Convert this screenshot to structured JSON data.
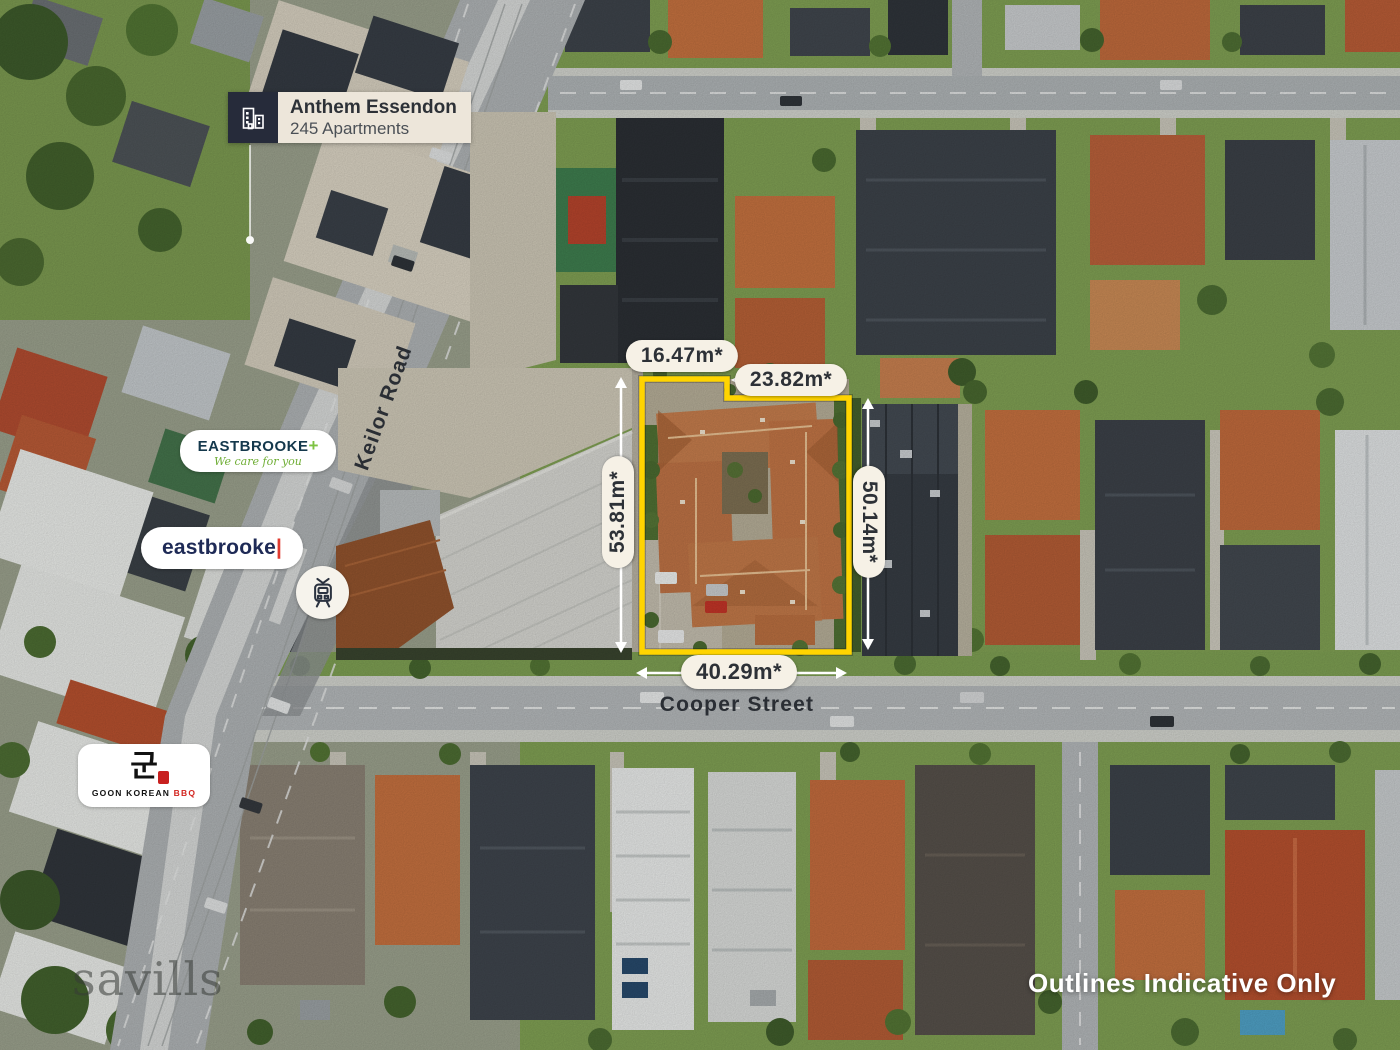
{
  "annotations": {
    "anthem": {
      "title": "Anthem Essendon",
      "subtitle": "245 Apartments"
    },
    "eastbrooke_medical": {
      "name": "EASTBROOKE",
      "plus": "+",
      "tagline": "We care for you"
    },
    "eastbrooke": {
      "name": "eastbrooke",
      "cursor": "|"
    },
    "goon": {
      "hangul": "군",
      "name_black": "GOON KOREAN",
      "name_red": "BBQ"
    },
    "streets": {
      "keilor": "Keilor Road",
      "cooper": "Cooper Street"
    },
    "dimensions": {
      "top_left": "16.47m*",
      "top_right": "23.82m*",
      "left": "53.81m*",
      "right": "50.14m*",
      "bottom": "40.29m*"
    },
    "watermark": "savills",
    "disclaimer": "Outlines Indicative Only"
  },
  "icons": {
    "tram": "tram-icon",
    "apartments": "building-icon"
  },
  "colors": {
    "boundary_yellow": "#FFD400",
    "pill_bg": "#F6F1E6",
    "pill_text": "#2D3137",
    "anthem_navy": "#262B3A",
    "anthem_label_bg": "#EDE6DA",
    "eastbrooke_navy": "#14384C",
    "eastbrooke_green": "#7DC242",
    "eastbrooke_blue": "#1E2A56",
    "eastbrooke_red": "#E03A2F",
    "goon_red": "#C8201F",
    "dimension_line": "#FFFFFF"
  }
}
